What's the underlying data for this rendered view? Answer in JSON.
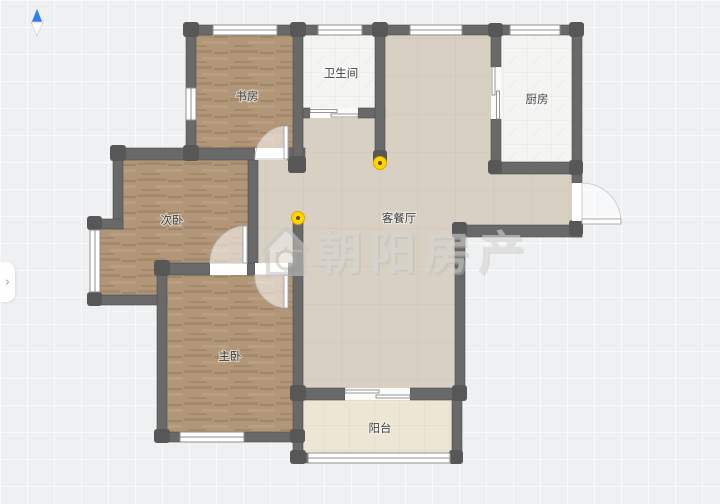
{
  "watermark": {
    "text": "朝阳房产",
    "icon": "house-logo-icon"
  },
  "rooms": {
    "study": {
      "label": "书房"
    },
    "bathroom": {
      "label": "卫生间"
    },
    "kitchen": {
      "label": "厨房"
    },
    "secondary_bedroom": {
      "label": "次卧"
    },
    "living_dining": {
      "label": "客餐厅"
    },
    "master_bedroom": {
      "label": "主卧"
    },
    "balcony": {
      "label": "阳台"
    }
  },
  "markers": {
    "count": 2,
    "description": "yellow ceiling-light markers"
  },
  "expand_tab": {
    "glyph": "›"
  },
  "colors": {
    "bg": "#eef0f2",
    "grid": "#f9fafb",
    "wall": "#696969",
    "wall_post": "#575757",
    "wood": "#b19678",
    "tile": "#f4f4f3",
    "beige": "#d8d0c3",
    "cream": "#ece6d4",
    "marker_yellow": "#ffd400",
    "compass_blue": "#2e7cf6",
    "watermark_gray": "#d0cfcd"
  }
}
